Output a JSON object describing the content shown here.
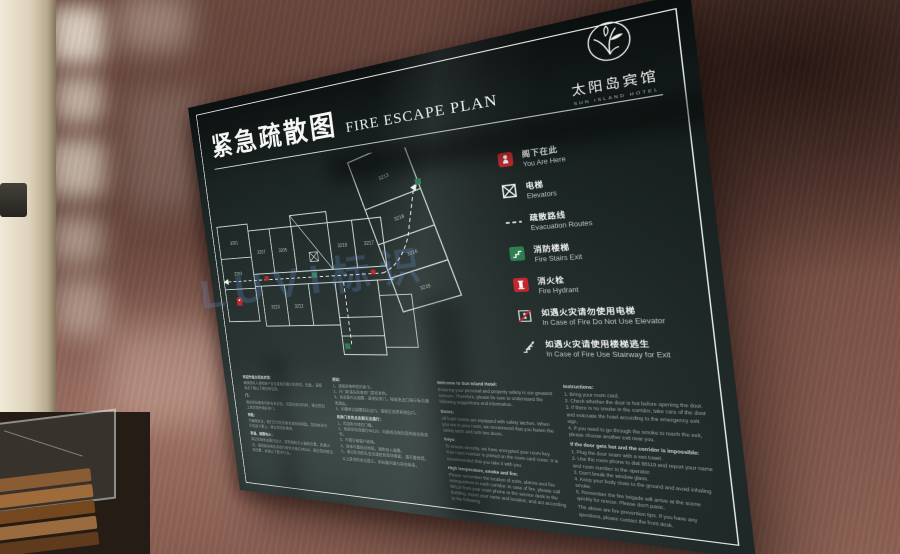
{
  "photo": {
    "watermark": "LUVI标识"
  },
  "colors": {
    "sign_bg": "#1c2626",
    "red": "#c1272d",
    "green": "#2e7d4f",
    "white": "#f4f6f4",
    "wood": "#6d4a40",
    "watermark_blue": "#6c9ee8"
  },
  "sign": {
    "title_cn": "紧急疏散图",
    "title_en": "FIRE ESCAPE PLAN",
    "logo": {
      "cn": "太阳岛宾馆",
      "en": "SUN ISLAND HOTEL"
    },
    "legend": [
      {
        "icon": "you-are-here",
        "cn": "阁下在此",
        "en": "You Are Here"
      },
      {
        "icon": "elevator",
        "cn": "电梯",
        "en": "Elevators"
      },
      {
        "icon": "route",
        "cn": "疏散路线",
        "en": "Evacuation Routes"
      },
      {
        "icon": "fire-stairs",
        "cn": "消防楼梯",
        "en": "Fire Stairs Exit"
      },
      {
        "icon": "hydrant",
        "cn": "消火栓",
        "en": "Fire Hydrant"
      },
      {
        "icon": "no-elevator",
        "cn": "如遇火灾请勿使用电梯",
        "en": "In Case of Fire Do Not Use Elevator"
      },
      {
        "icon": "stair-exit",
        "cn": "如遇火灾请使用楼梯逃生",
        "en": "In Case of Fire Use Stairway for Exit"
      }
    ],
    "floorplan": {
      "rooms": [
        "3213",
        "3218",
        "3216",
        "3215",
        "3219",
        "3217",
        "3205",
        "3207",
        "3201",
        "3203",
        "3210",
        "3212"
      ]
    },
    "notices": {
      "cn1": {
        "t0": "欢迎光临太阳岛宾馆：",
        "p0": "确保您的人身和财产安全是我们最大的关切。因此，请您务必了解以下建议和信息。",
        "t1": "门：",
        "p1": "酒店所有客房均装有安全锁。当您在房间内时，建议您扣上安全锁并锁好房门。",
        "t2": "钥匙：",
        "p2": "为确保安全，我们已为您妥善安排房间钥匙。您的房间号印在房卡套上，建议您随身携带。",
        "t3": "高温、烟雾和火：",
        "p3": "请记住每条走廊内出口、报警器和灭火器的位置。如遇火灾，请用房间电话或楼内服务台拨打88119，报告您的姓名和位置，并按以下要求行动。"
      },
      "cn2": {
        "t0": "须知：",
        "p0": "1、请随身携带您的房卡。\n2、开门前请先检查房门是否发热。\n3、如走廊内无烟雾，请关好房门，按紧急出口指示标志撤离酒店。\n4、如需穿过烟雾到达出口，请就近选择其他出口。",
        "t1": "如房门发热且走廊无法通行：",
        "p1": "1、用湿毛巾堵住门缝。\n2、用房间电话拨打88119，向接线员报告您的姓名和房号。\n3、不要打破窗户玻璃。\n4、身体尽量贴近地面，避免吸入烟雾。\n5、请记住消防队会迅速赶到现场救援，请不要惊慌。",
        "p2": "以上是消防安全提示，如有疑问请与前台联系。"
      },
      "en1": {
        "t0": "Welcome to Sun Island Hotel:",
        "p0": "Ensuring your personal and property safety is our greatest concern. Therefore, please be sure to understand the following suggestions and information.",
        "t1": "Doors:",
        "p1": "All hotel rooms are equipped with safety latches. When you are in your room, we recommend that you fasten the safety latch and lock two doors.",
        "t2": "Keys:",
        "p2": "To ensure security, we have encrypted your room key. Your room number is printed on the room card cover. It is recommended that you take it with you.",
        "t3": "High temperature, smoke and fire:",
        "p3": "Please remember the location of exits, alarms and fire extinguishers in each corridor. In case of fire, please call 88119 from your room phone or the service desk in the building, report your name and location, and act according to the following."
      },
      "en2": {
        "t0": "Instructions:",
        "p0": "1. Bring your room card.\n2. Check whether the door is hot before opening the door.\n3. If there is no smoke in the corridor, take care of the door and evacuate the hotel according to the emergency exit sign.\n4. If you need to go through the smoke to reach the exit, please choose another exit near you.",
        "t1": "If the door gets hot and the corridor is impossible:",
        "p1": "1. Plug the door seam with a wet towel.\n2. Use the room phone to dial 88119 and report your name and room number to the operator.\n3. Don't break the window glass.\n4. Keep your body close to the ground and avoid inhaling smoke.\n5. Remember the fire brigade will arrive at the scene quickly for rescue. Please don't panic.",
        "p2": "The above are fire prevention tips. If you have any questions, please contact the front desk."
      }
    }
  }
}
